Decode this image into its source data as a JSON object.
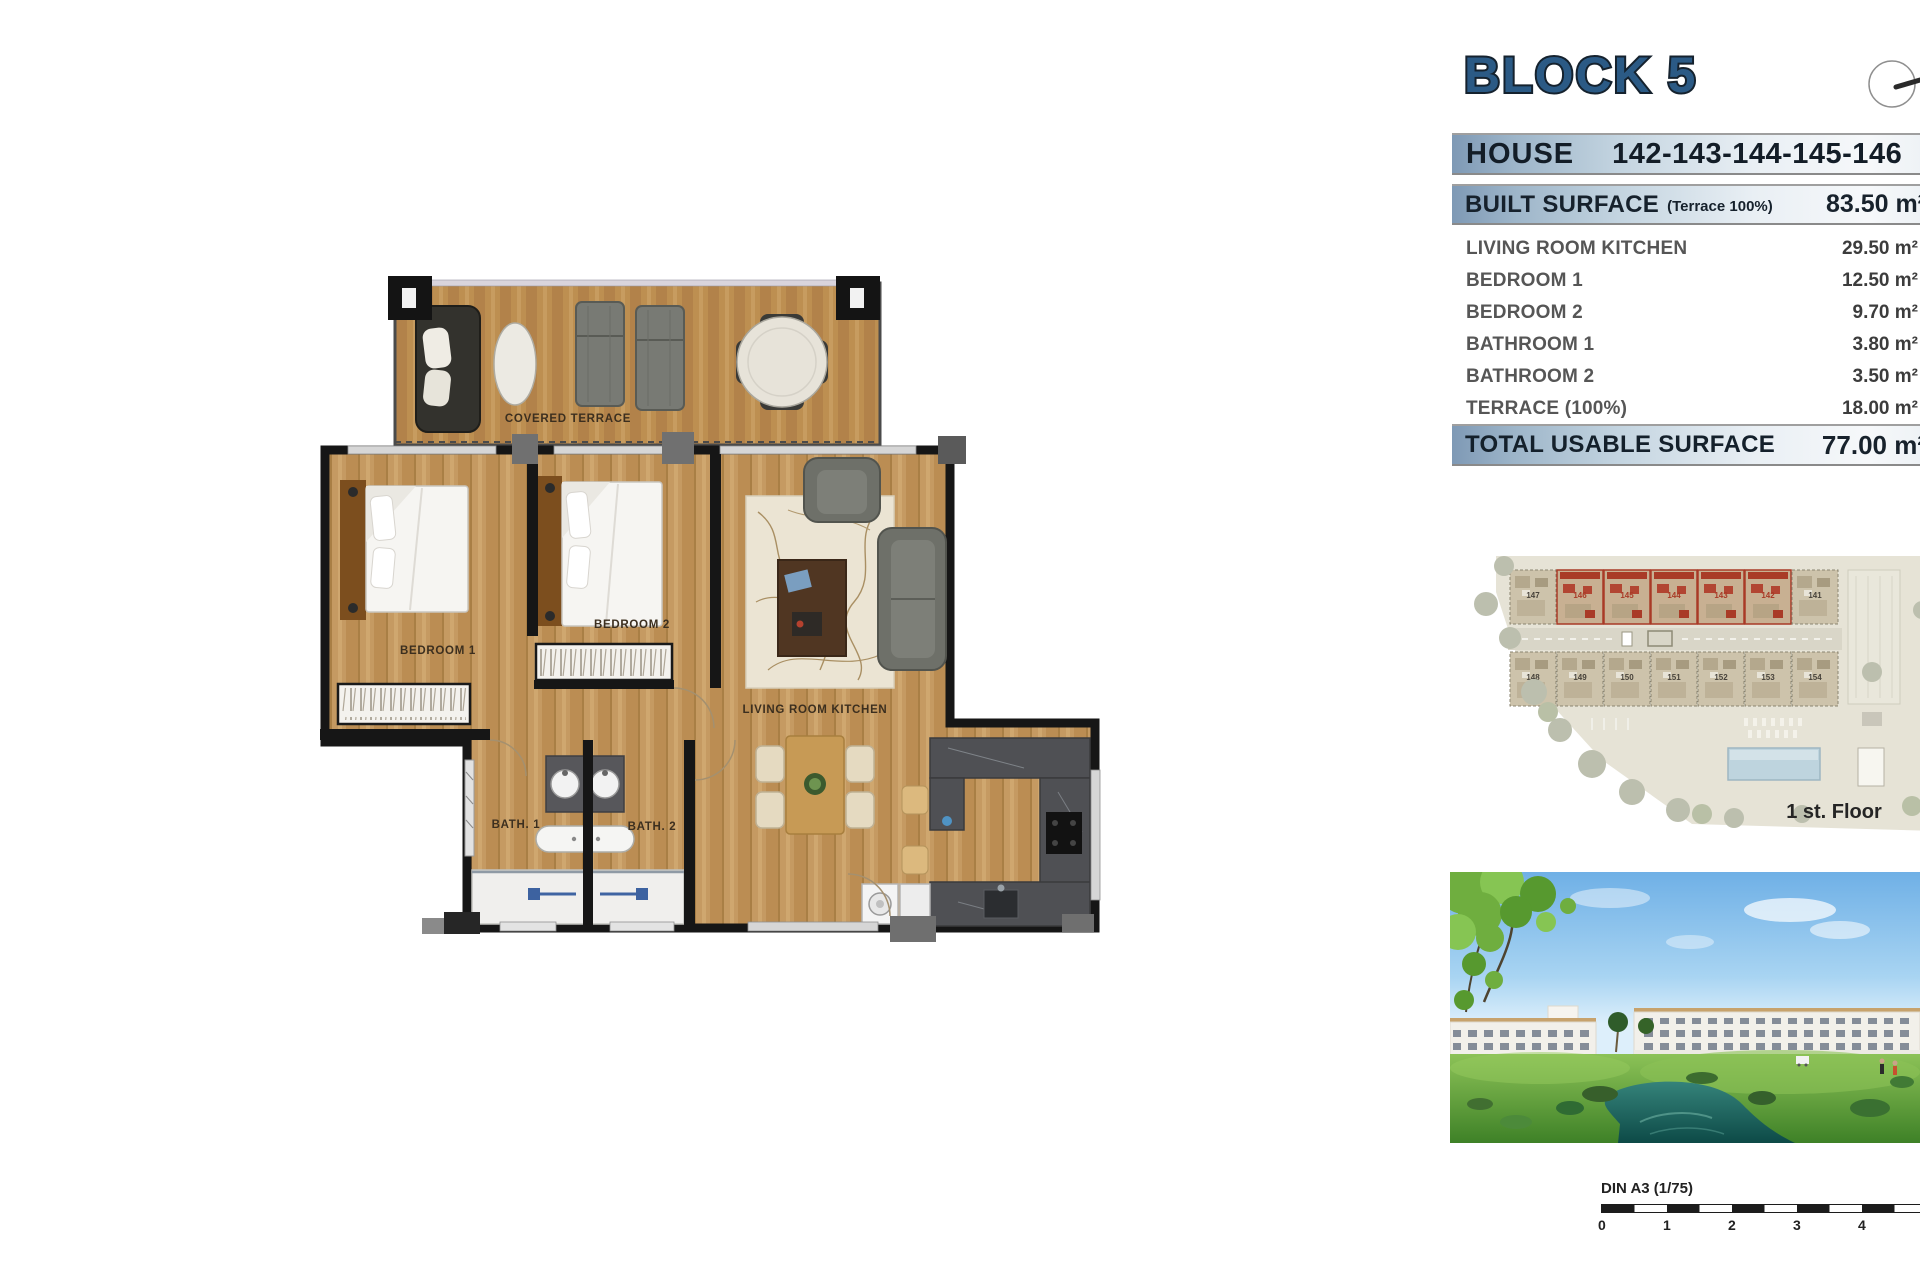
{
  "header": {
    "block_title": "BLOCK 5",
    "house_label": "HOUSE",
    "house_numbers": "142-143-144-145-146"
  },
  "surface_table": {
    "built_surface_label": "BUILT SURFACE",
    "built_surface_note": "(Terrace 100%)",
    "built_surface_value": "83.50 m²",
    "rows": [
      {
        "label": "LIVING ROOM KITCHEN",
        "value": "29.50 m²"
      },
      {
        "label": "BEDROOM 1",
        "value": "12.50 m²"
      },
      {
        "label": "BEDROOM 2",
        "value": "9.70 m²"
      },
      {
        "label": "BATHROOM 1",
        "value": "3.80 m²"
      },
      {
        "label": "BATHROOM 2",
        "value": "3.50 m²"
      },
      {
        "label": "TERRACE (100%)",
        "value": "18.00 m²"
      }
    ],
    "total_label": "TOTAL USABLE SURFACE",
    "total_value": "77.00 m²"
  },
  "floor_plan": {
    "labels": {
      "terrace": "COVERED TERRACE",
      "bedroom1": "BEDROOM 1",
      "bedroom2": "BEDROOM 2",
      "living": "LIVING ROOM KITCHEN",
      "bath1": "BATH. 1",
      "bath2": "BATH. 2"
    }
  },
  "site_plan": {
    "floor_label": "1 st. Floor",
    "top_row_units": [
      "147",
      "146",
      "145",
      "144",
      "143",
      "142",
      "141"
    ],
    "bottom_row_units": [
      "148",
      "149",
      "150",
      "151",
      "152",
      "153",
      "154"
    ]
  },
  "scale_bar": {
    "label": "DIN A3 (1/75)",
    "ticks": [
      "0",
      "1",
      "2",
      "3",
      "4"
    ]
  },
  "colors": {
    "title_blue": "#2b5a85",
    "bar_blue": "#7e99b5",
    "highlight_red": "#a93b27",
    "wood": "#c59a62",
    "water_teal": "#18615c"
  }
}
